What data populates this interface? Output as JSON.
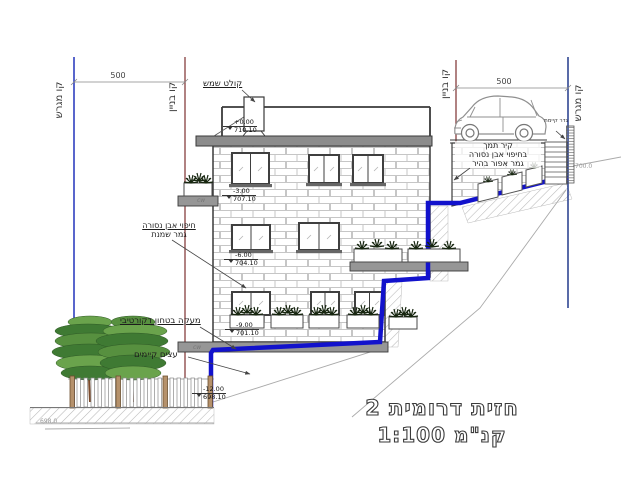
{
  "title": {
    "line1": "חזית דרומית 2",
    "line2": "קנ\"מ 1:100"
  },
  "boundaries": {
    "left_lot": "קו מגרש",
    "left_building": "קו בניין",
    "right_building": "קו בניין",
    "right_lot": "קו מגרש"
  },
  "dimensions": {
    "left": "500",
    "right": "500"
  },
  "levels": [
    {
      "rel": "+0.00",
      "abs": "710.10"
    },
    {
      "rel": "-3.00",
      "abs": "707.10"
    },
    {
      "rel": "-6.00",
      "abs": "704.10"
    },
    {
      "rel": "-9.00",
      "abs": "701.10"
    },
    {
      "rel": "-12.00",
      "abs": "698.10"
    }
  ],
  "annotations": {
    "solar_heater": "קולט שמש",
    "cladding1": "חיפוי אבן נסורה",
    "cladding2": "גמר שמנת",
    "deco_railing": "מעקה בטחון דקורטיבי",
    "existing_trees": "עצים קיימים",
    "retaining1": "קיר תמך",
    "retaining2": "בחיפוי אבן נסורה",
    "retaining3": "גמר אפור בהיר",
    "existing_fence": "גדר קיימת",
    "topo_right": "700.0",
    "topo_left": "698.0",
    "slab_mark": "cw"
  },
  "colors": {
    "section_line": "#1212cc",
    "lot_line": "#2233bb",
    "building_line": "#7d2f2f",
    "roof_slab": "#8c8c8c",
    "foliage_dark": "#3f7a33",
    "foliage_light": "#6aa34c",
    "trunk": "#7c4a2a",
    "fence_post": "#b5916b"
  }
}
